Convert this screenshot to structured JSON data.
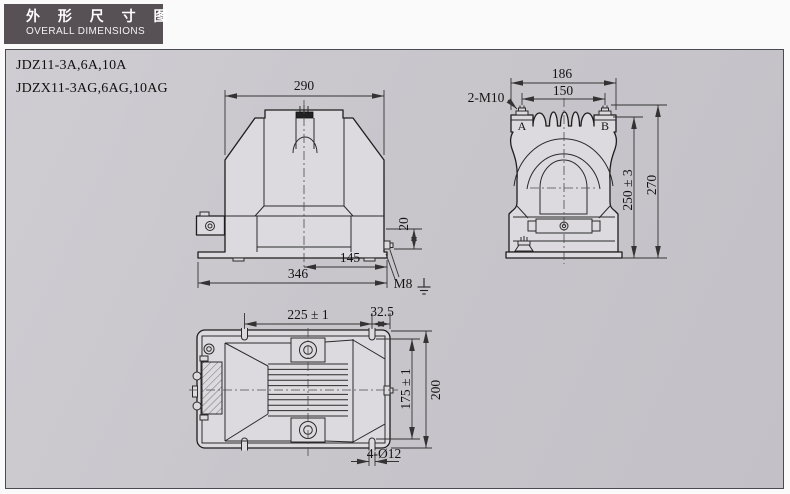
{
  "title_block": {
    "title_cn": "外 形 尺 寸 图",
    "title_en": "OVERALL DIMENSIONS"
  },
  "models": [
    "JDZ11-3A,6A,10A",
    "JDZX11-3AG,6AG,10AG"
  ],
  "colors": {
    "title_bg": "#575055",
    "panel_bg": "#c8c6cb",
    "body_fill": "#dcdade",
    "line": "#1d1d1d"
  },
  "dims": {
    "front": {
      "top_width": "290",
      "base_mid": "145",
      "base_full": "346",
      "ground_height": "20",
      "ground_thread": "M8"
    },
    "side": {
      "outer_span": "186",
      "terminal_pitch": "150",
      "terminal_thread": "2-M10",
      "terminal_a": "A",
      "terminal_b": "B",
      "body_height": "250 ± 3",
      "total_height": "270"
    },
    "bottom": {
      "slot_span": "225 ± 1",
      "edge_offset": "32.5",
      "slot_span_v": "175 ± 1",
      "total_depth": "200",
      "mount_holes": "4-Ø12"
    }
  }
}
